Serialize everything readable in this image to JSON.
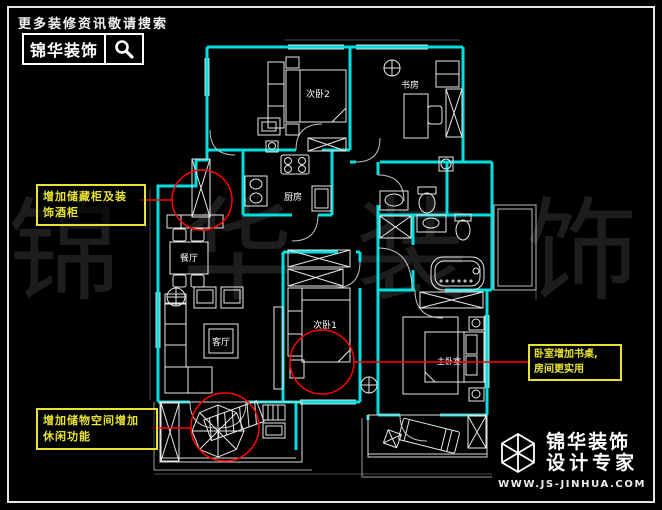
{
  "header": {
    "tagline": "更多装修资讯敬请搜索",
    "brand": "锦华装饰"
  },
  "watermark": {
    "chars": [
      "锦",
      "华",
      "装",
      "饰"
    ]
  },
  "plan": {
    "rooms": [
      {
        "id": "bedroom-2",
        "label": "次卧2"
      },
      {
        "id": "study",
        "label": "书房"
      },
      {
        "id": "kitchen",
        "label": "厨房"
      },
      {
        "id": "dining",
        "label": "餐厅"
      },
      {
        "id": "living",
        "label": "客厅"
      },
      {
        "id": "bedroom-1",
        "label": "次卧1"
      },
      {
        "id": "master-bedroom",
        "label": "主卧室"
      }
    ],
    "notes": [
      {
        "id": "note-storage-wine",
        "lines": [
          "增加储藏柜及装",
          "饰酒柜"
        ]
      },
      {
        "id": "note-leisure",
        "lines": [
          "增加储物空间增加",
          "休闲功能"
        ]
      },
      {
        "id": "note-desk",
        "lines": [
          "卧室增加书桌,",
          "房间更实用"
        ]
      }
    ]
  },
  "footer": {
    "brand": "锦华装饰",
    "slogan": "设计专家",
    "url": "WWW.JS-JINHUA.COM"
  },
  "colors": {
    "wall": "#00DEDE",
    "furniture": "#E8E8E8",
    "annotation": "#FF0000",
    "note": "#E8E332",
    "watermark": "#1D1D1D"
  }
}
